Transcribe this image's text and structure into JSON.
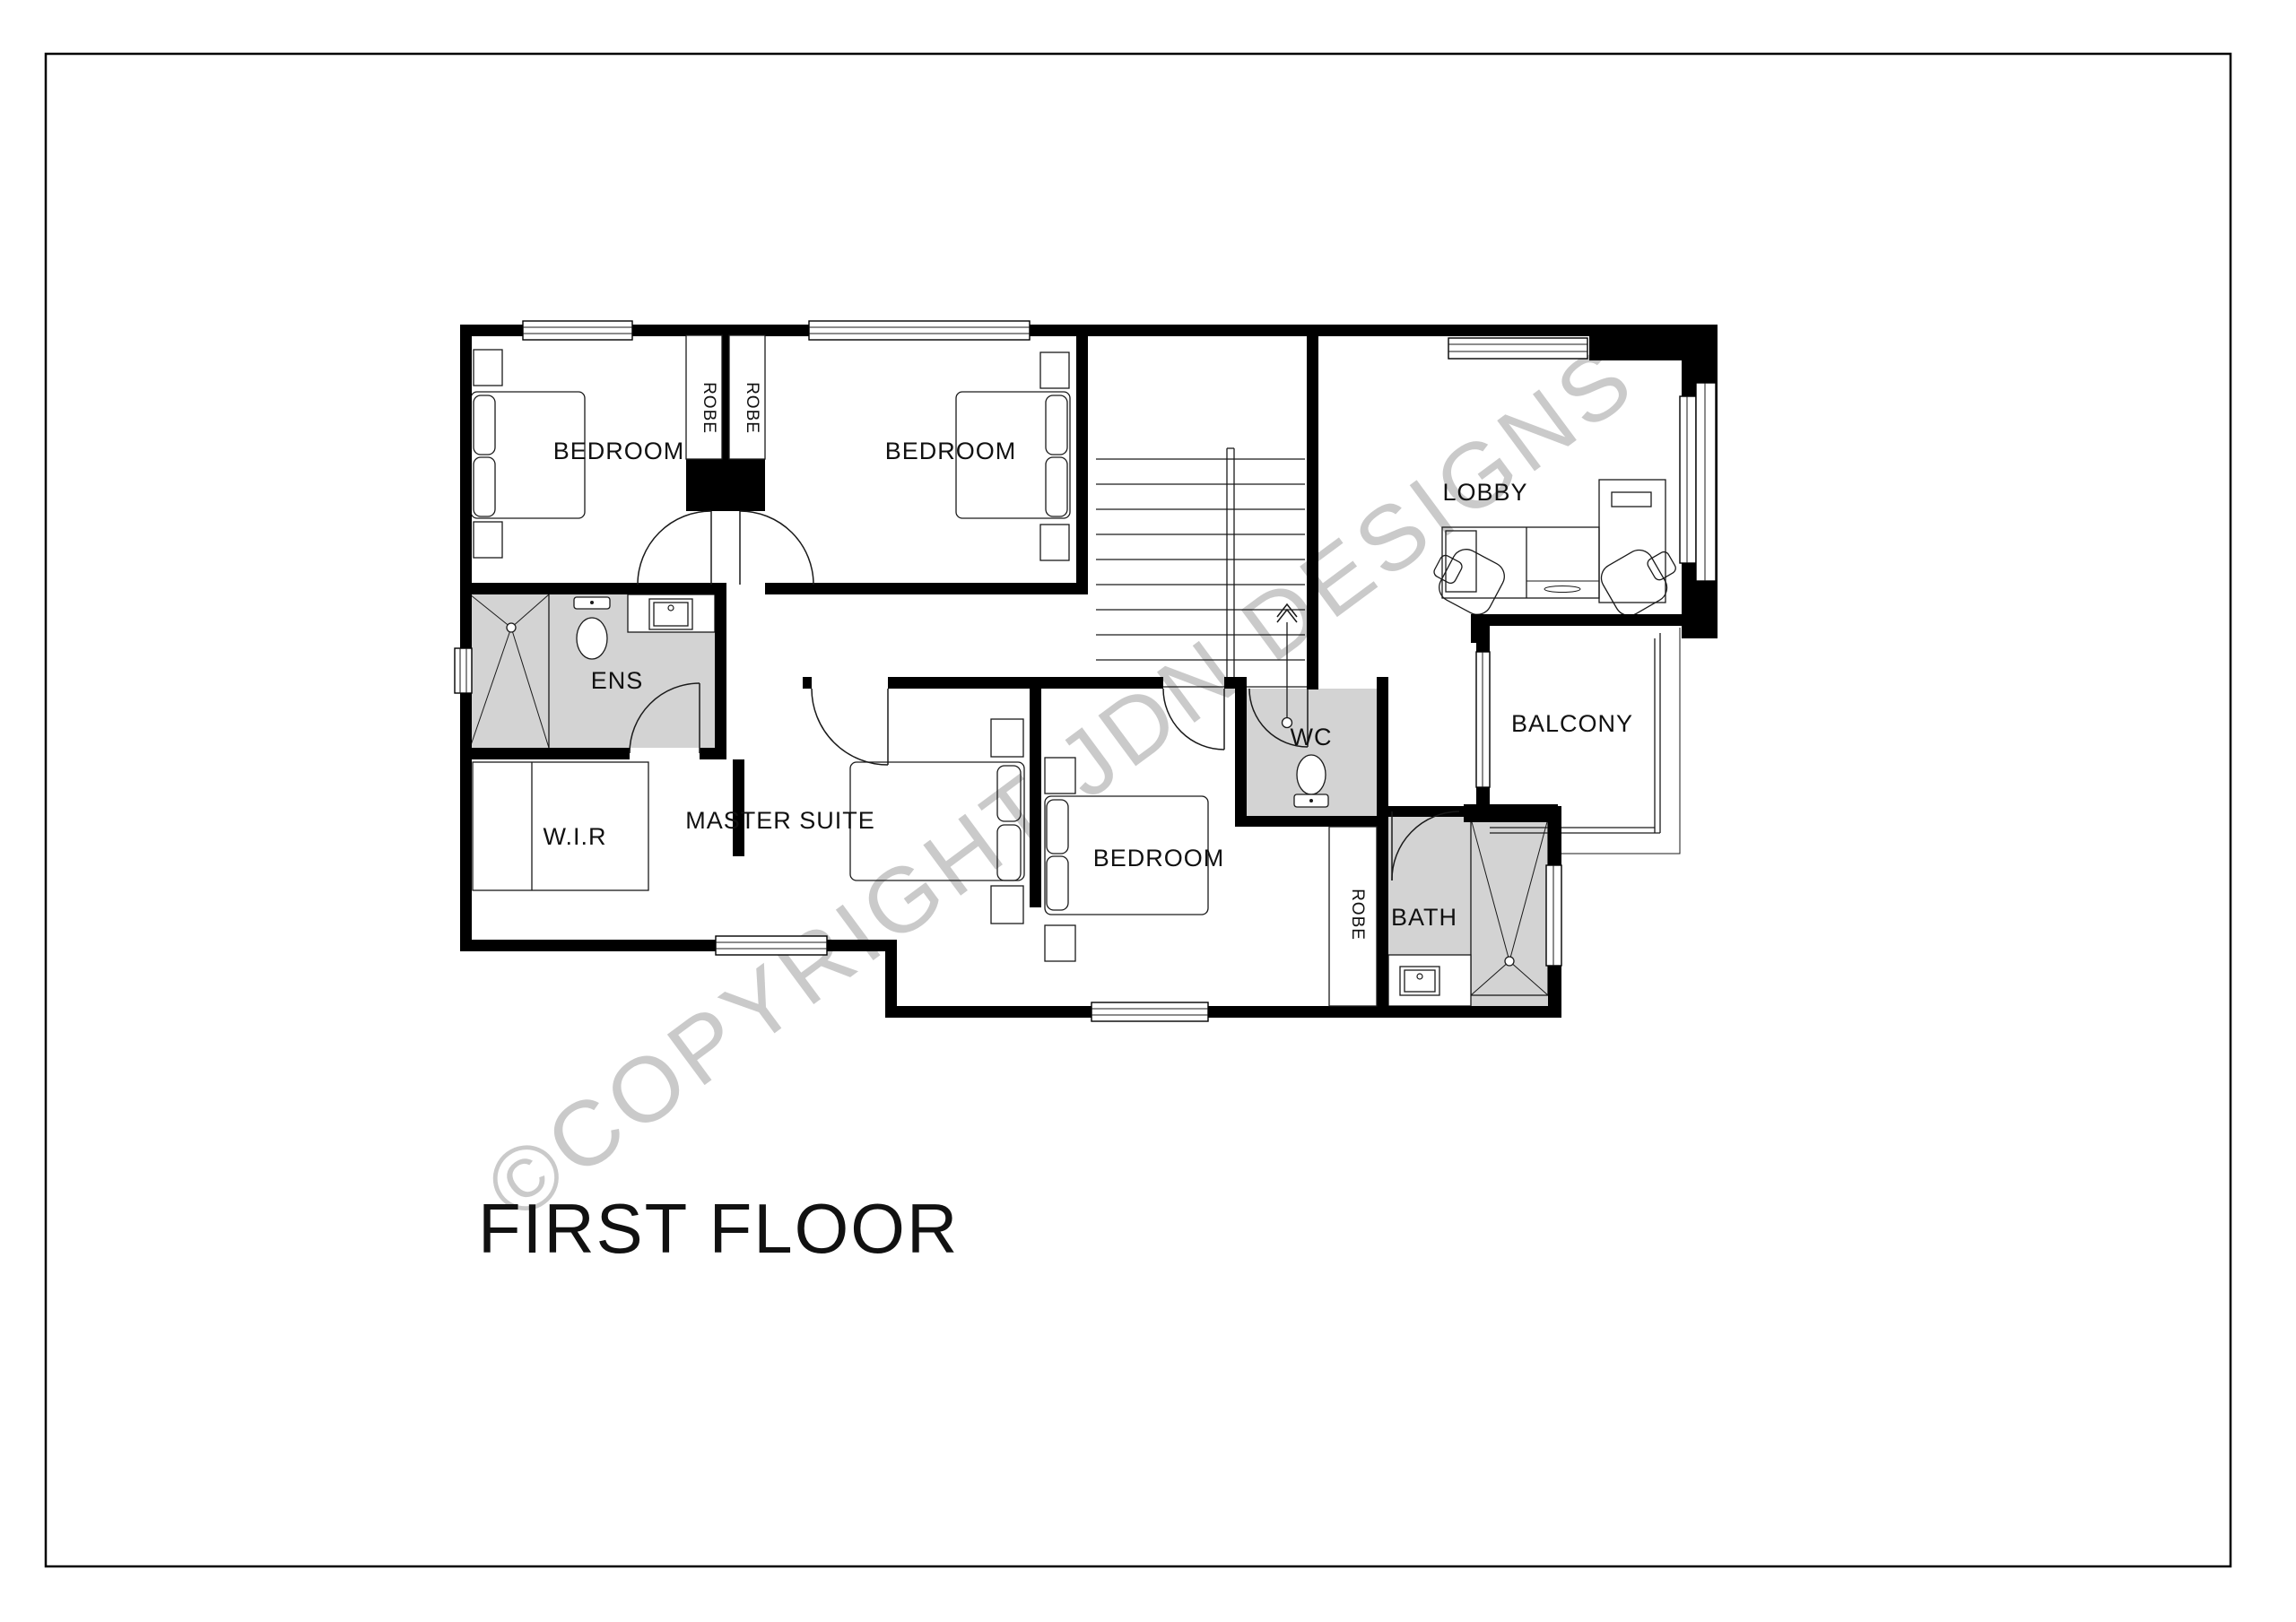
{
  "title": "FIRST FLOOR",
  "watermark": "©COPYRIGHT  JDN DESIGNS",
  "rooms": {
    "bedroom_top_left": "BEDROOM",
    "bedroom_top_mid": "BEDROOM",
    "lobby": "LOBBY",
    "ens": "ENS",
    "wir": "W.I.R",
    "master_suite": "MASTER SUITE",
    "bedroom_bottom": "BEDROOM",
    "wc": "WC",
    "balcony": "BALCONY",
    "bath": "BATH",
    "robe_top_1": "ROBE",
    "robe_top_2": "ROBE",
    "robe_bottom": "ROBE"
  },
  "colors": {
    "wall": "#000000",
    "wet_floor": "#d3d3d3",
    "watermark": "#c8c8c8",
    "text": "#111111",
    "page_border": "#000000"
  }
}
